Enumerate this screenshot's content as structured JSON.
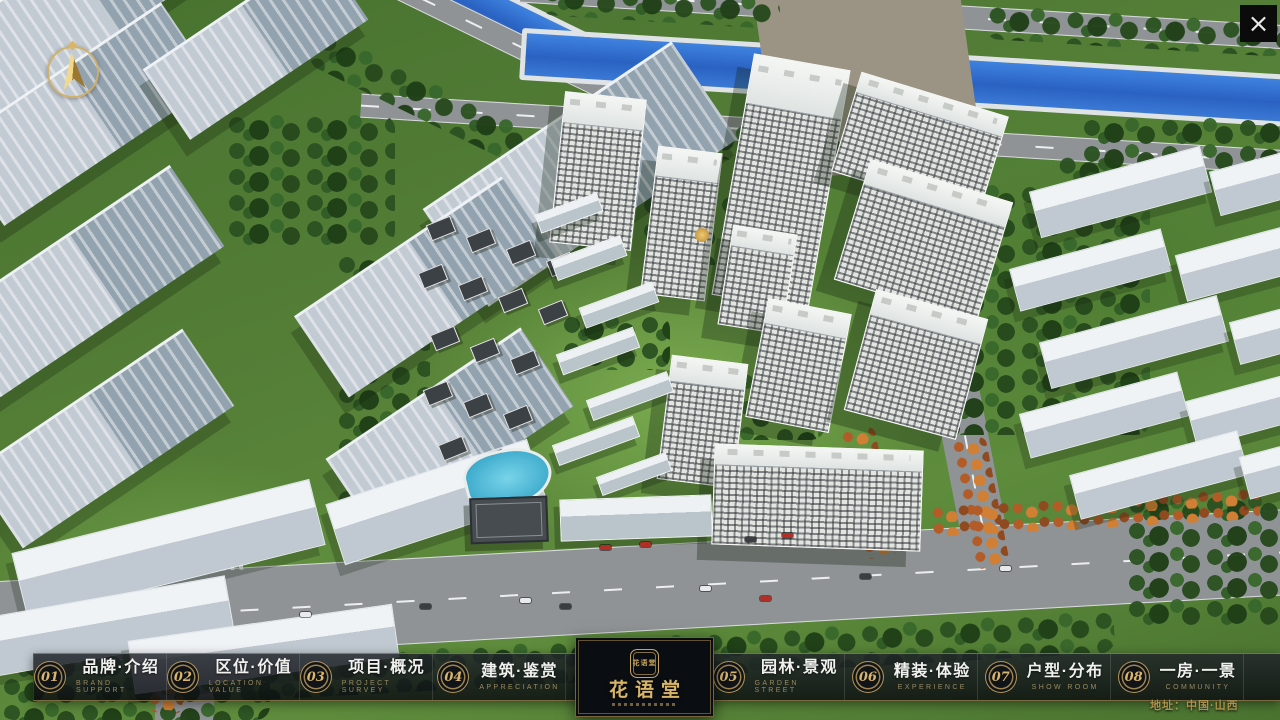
{
  "window": {
    "close_label": "×"
  },
  "compass": {
    "icon": "north-arrow"
  },
  "nav": {
    "items": [
      {
        "num": "01",
        "zh": "品牌·介绍",
        "en": "BRAND SUPPORT"
      },
      {
        "num": "02",
        "zh": "区位·价值",
        "en": "LOCATION VALUE"
      },
      {
        "num": "03",
        "zh": "项目·概况",
        "en": "PROJECT SURVEY"
      },
      {
        "num": "04",
        "zh": "建筑·鉴赏",
        "en": "APPRECIATION"
      },
      {
        "num": "05",
        "zh": "园林·景观",
        "en": "GARDEN STREET"
      },
      {
        "num": "06",
        "zh": "精装·体验",
        "en": "EXPERIENCE"
      },
      {
        "num": "07",
        "zh": "户型·分布",
        "en": "SHOW ROOM"
      },
      {
        "num": "08",
        "zh": "一房·一景",
        "en": "COMMUNITY"
      }
    ]
  },
  "logo": {
    "title": "花语堂",
    "seal": "花语堂"
  },
  "footer": {
    "address": "地址：中国·山西"
  },
  "colors": {
    "accent_gold": "#c9a55e",
    "nav_text": "#f1f2ef",
    "nav_subtext": "#9a8a5f",
    "river_blue": "#2f6fd0"
  }
}
